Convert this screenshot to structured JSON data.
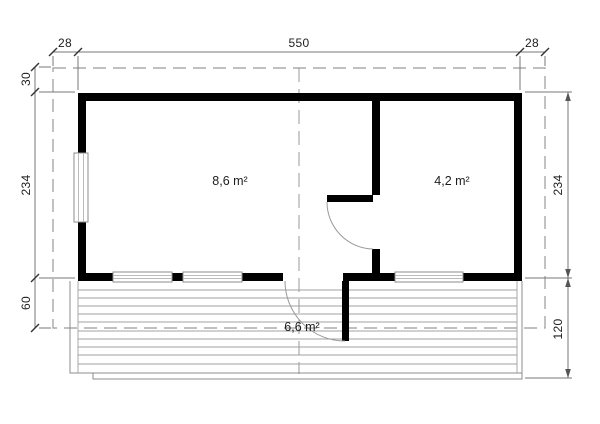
{
  "plan": {
    "dimensions": {
      "top": [
        "28",
        "550",
        "28"
      ],
      "left": [
        "30",
        "234",
        "60"
      ],
      "right": [
        "234",
        "120"
      ]
    },
    "rooms": {
      "main_room_area": "8,6 m²",
      "side_room_area": "4,2 m²",
      "terrace_area": "6,6 m²"
    },
    "colors": {
      "wall": "#000000",
      "thin_line": "#777777",
      "dashed_line": "#9a9a9a",
      "deck_line": "#8c8c8c",
      "text": "#1d1d1d"
    }
  }
}
